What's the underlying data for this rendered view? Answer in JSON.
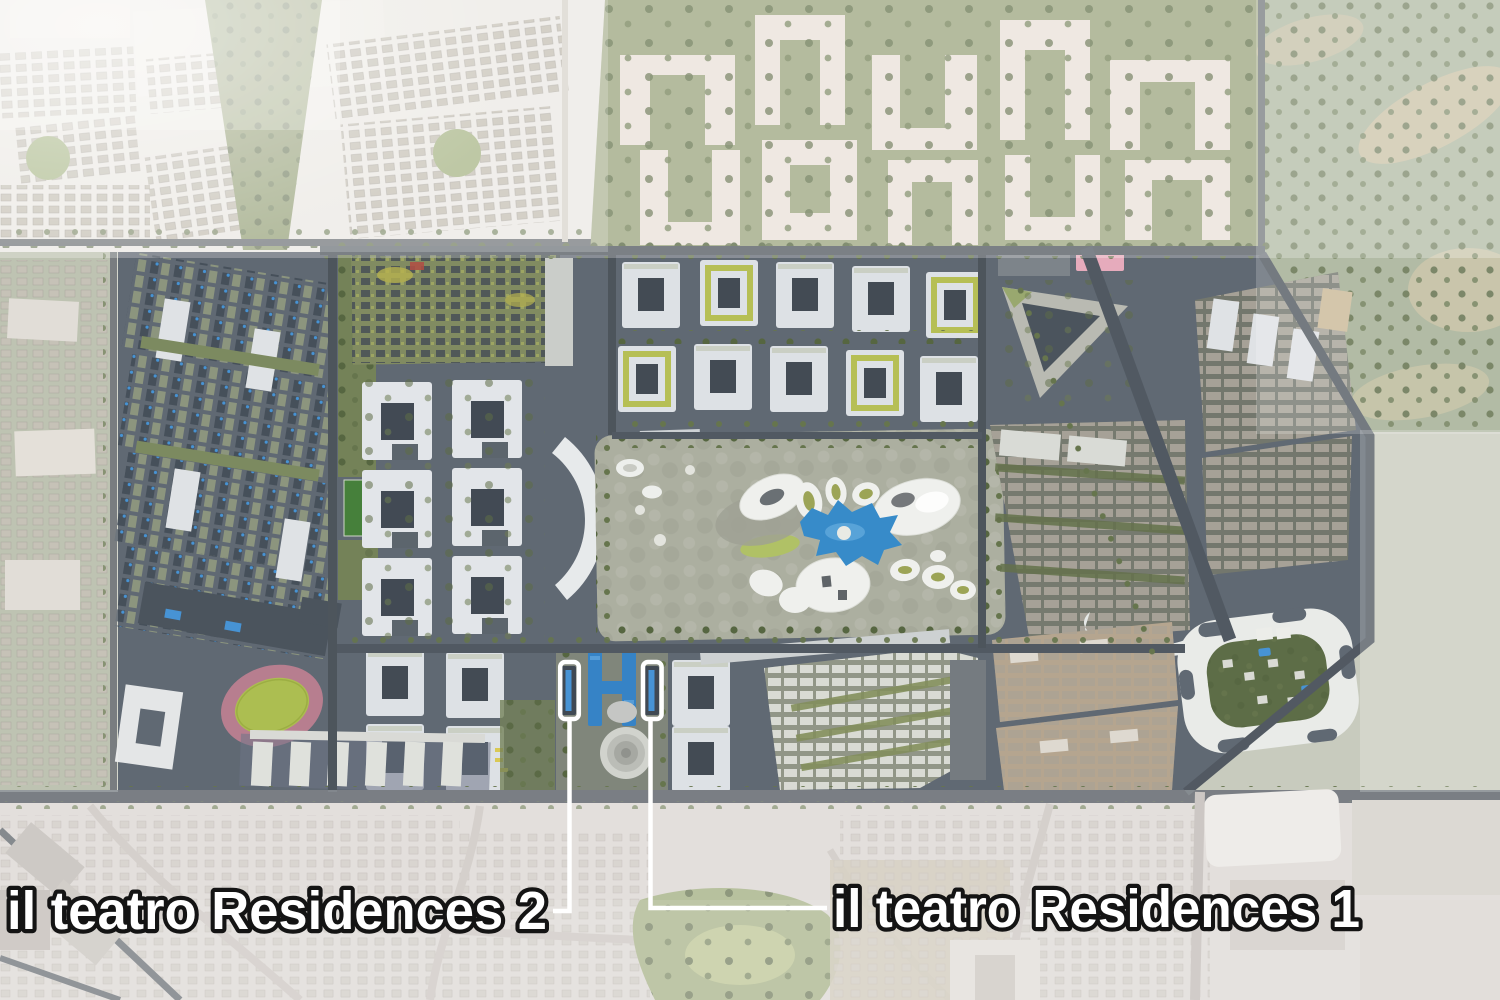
{
  "annotations": {
    "residences_2": {
      "label": "il teatro Residences 2"
    },
    "residences_1": {
      "label": "il teatro Residences 1"
    }
  },
  "colors": {
    "annotation_text": "#ffffff",
    "annotation_outline": "#141414",
    "leader_line": "#ffffff",
    "highlight_box": "#ffffff",
    "lagoon_blue": "#2e86c9",
    "pool_blue": "#3f8fd4",
    "plaza_pool_blue": "#2d7ec6",
    "track_pink": "#b5798c",
    "track_infield_green": "#a9bc4a",
    "pitch_green": "#3e7b33",
    "park_grey_green": "#a9ac9d",
    "dark_ground": "#59626e",
    "white_building": "#eceeec",
    "olive_ground": "#97a179",
    "haze": "#ffffff"
  }
}
